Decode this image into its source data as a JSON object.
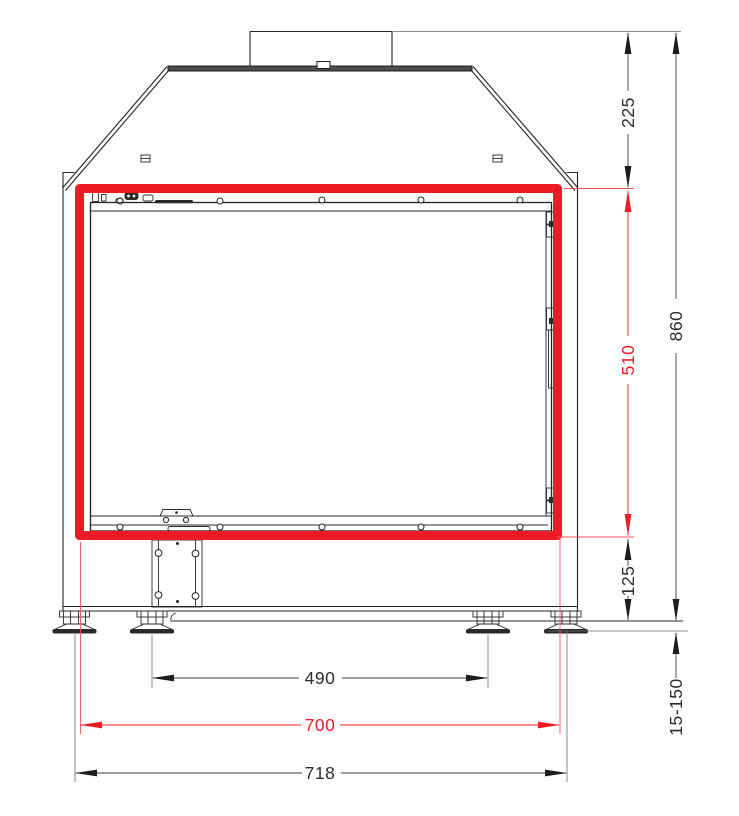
{
  "document": {
    "type": "technical-dimension-drawing",
    "subject": "fireplace-insert-front-view"
  },
  "colors": {
    "highlight_red": "#ed1c24",
    "line_black": "#222222"
  },
  "dims": {
    "d225": "225",
    "d860": "860",
    "d510": "510",
    "d125": "125",
    "d15_150": "15-150",
    "d490": "490",
    "d700": "700",
    "d718": "718"
  }
}
